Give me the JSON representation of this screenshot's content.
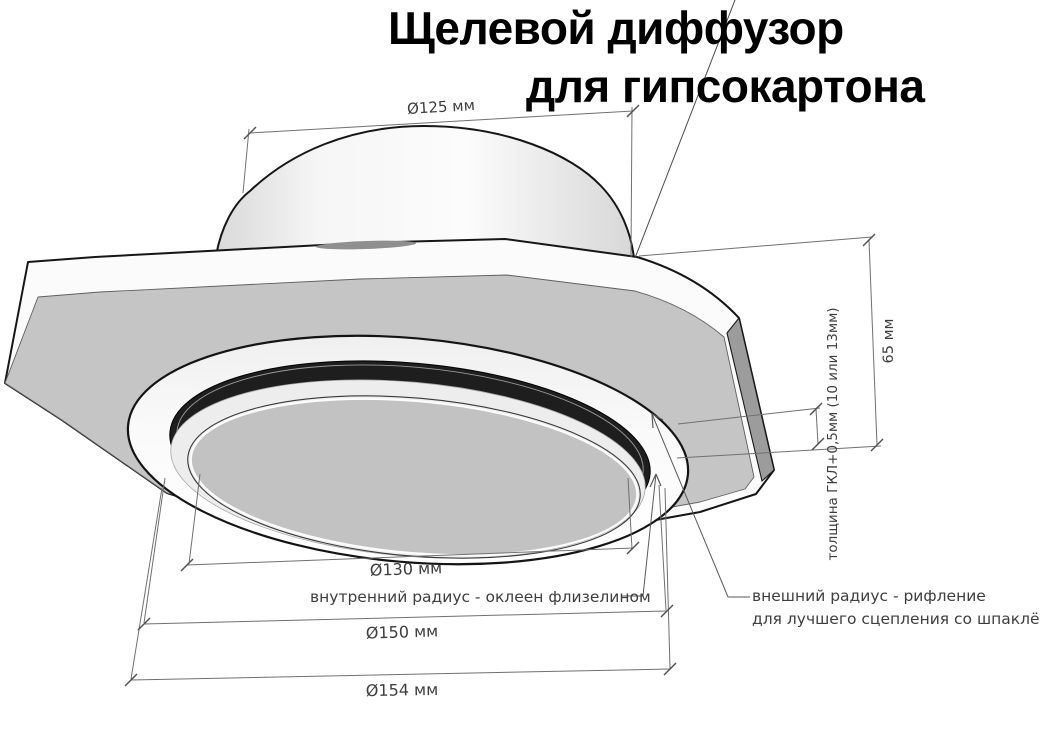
{
  "title": {
    "line1": "Щелевой диффузор",
    "line2": "для гипсокартона"
  },
  "dimensions": {
    "duct_diameter": "Ø125 мм",
    "height": "65 мм",
    "board_thickness": "толщина ГКЛ+0,5мм (10 или 13мм)",
    "inner_diameter": "Ø130 мм",
    "flange_diameter": "Ø150 мм",
    "outer_diameter": "Ø154 мм"
  },
  "annotations": {
    "inner_radius": "внутренний радиус - оклеен флизелином",
    "outer_radius_line1": "внешний радиус - рифление",
    "outer_radius_line2": "для лучшего сцепления со шпаклёвкой"
  },
  "colors": {
    "background": "#ffffff",
    "plate_face": "#c5c5c5",
    "plate_edge": "#fbfbfb",
    "bevel_edge": "#9c9c9c",
    "slot_channel": "#1e1e1e",
    "inner_disc": "#c2c2c2",
    "outline": "#1a1a1a",
    "dimension_line": "#707070",
    "dimension_text": "#3e3e3e",
    "title_text": "#000000"
  }
}
